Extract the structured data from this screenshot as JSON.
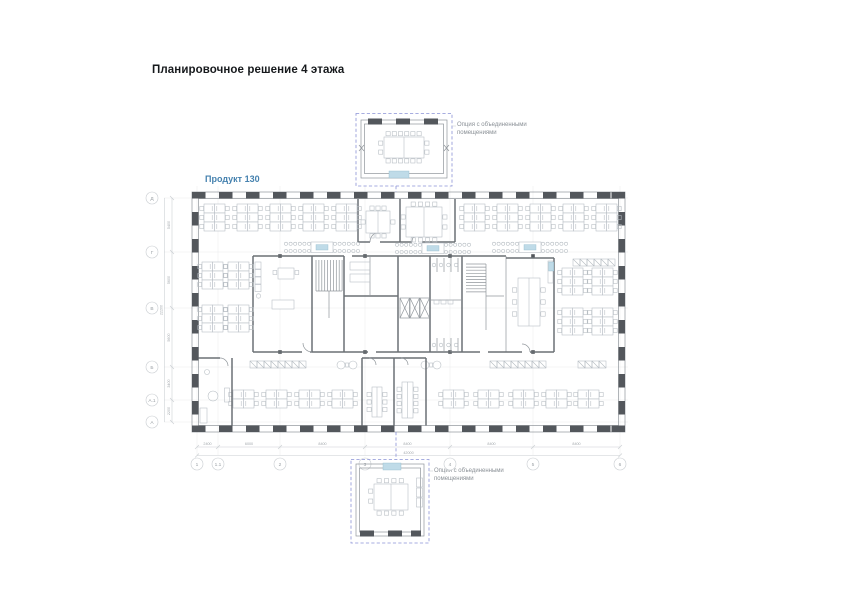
{
  "page": {
    "title": "Планировочное решение 4 этажа"
  },
  "plan": {
    "product_label": "Продукт 130",
    "annotations": {
      "top_option": "Опция с объединенными помещениями",
      "bottom_option": "Опция с объединенными помещениями"
    },
    "colors": {
      "product_label": "#4682af",
      "option_dashed": "#8a92d6",
      "option_highlight": "#bfdbe8",
      "wall_dark": "#53575c"
    },
    "grid": {
      "bottom": {
        "labels": [
          "1",
          "1.1",
          "2",
          "3",
          "4",
          "5",
          "6"
        ],
        "dims": [
          "2400",
          "6000",
          "8400",
          "8400",
          "8400",
          "8400"
        ],
        "total": "42000"
      },
      "left": {
        "labels": [
          "Д",
          "Г",
          "В",
          "Б",
          "А.1",
          "А"
        ],
        "dims": [
          "5400",
          "5600",
          "5600",
          "3400",
          "2200"
        ],
        "total": "22200"
      }
    }
  }
}
